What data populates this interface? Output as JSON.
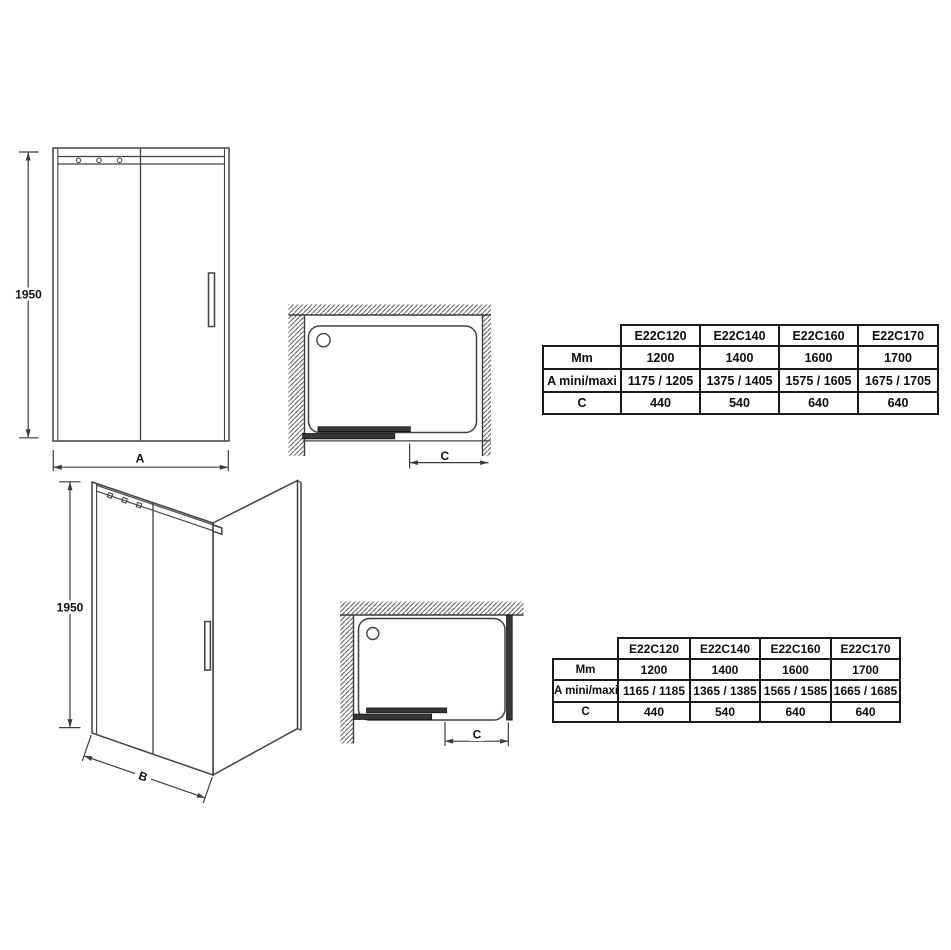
{
  "page": {
    "background": "#ffffff",
    "line_color": "#404040",
    "dark_bar_color": "#383838",
    "text_color": "#0d0d0d"
  },
  "drawings": {
    "front_view": {
      "height_label": "1950",
      "width_label": "A"
    },
    "plan_view_1": {
      "depth_label": "C"
    },
    "corner_view": {
      "height_label": "1950",
      "width_label": "B"
    },
    "plan_view_2": {
      "depth_label": "C"
    }
  },
  "tables": [
    {
      "columns": [
        "E22C120",
        "E22C140",
        "E22C160",
        "E22C170"
      ],
      "rows": [
        {
          "label": "Mm",
          "values": [
            "1200",
            "1400",
            "1600",
            "1700"
          ]
        },
        {
          "label": "A mini/maxi",
          "values": [
            "1175 / 1205",
            "1375 / 1405",
            "1575 / 1605",
            "1675 / 1705"
          ]
        },
        {
          "label": "C",
          "values": [
            "440",
            "540",
            "640",
            "640"
          ]
        }
      ]
    },
    {
      "columns": [
        "E22C120",
        "E22C140",
        "E22C160",
        "E22C170"
      ],
      "rows": [
        {
          "label": "Mm",
          "values": [
            "1200",
            "1400",
            "1600",
            "1700"
          ]
        },
        {
          "label": "A mini/maxi",
          "values": [
            "1165 / 1185",
            "1365 / 1385",
            "1565 / 1585",
            "1665 / 1685"
          ]
        },
        {
          "label": "C",
          "values": [
            "440",
            "540",
            "640",
            "640"
          ]
        }
      ]
    }
  ]
}
